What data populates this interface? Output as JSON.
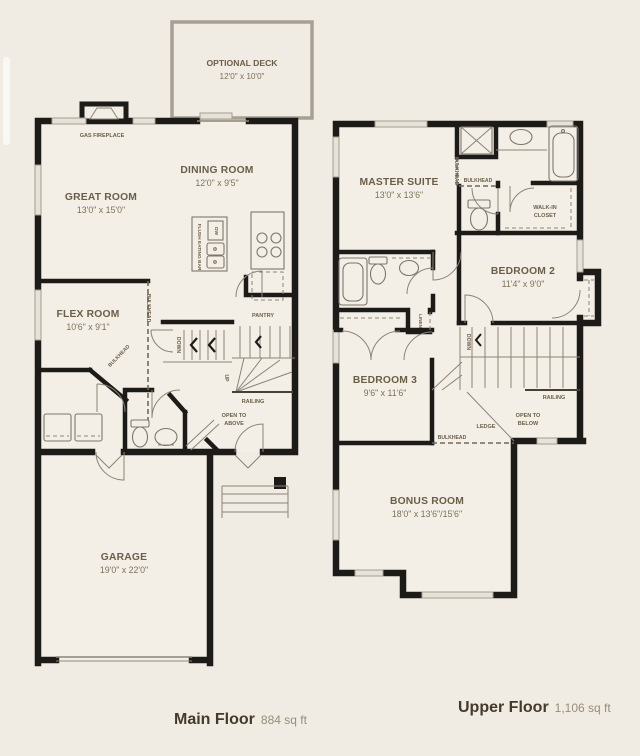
{
  "colors": {
    "background": "#f0ebe3",
    "wall": "#1c1b18",
    "label": "#6b5e46",
    "dim_label": "#7e7159",
    "deck_outline": "#a8a094",
    "caption_title": "#443a2c",
    "caption_area": "#9a8d79"
  },
  "main_floor": {
    "caption": "Main Floor",
    "area": "884 sq ft",
    "optional_deck": {
      "name": "OPTIONAL DECK",
      "dims": "12'0\" x 10'0\""
    },
    "gas_fireplace": "GAS FIREPLACE",
    "great_room": {
      "name": "GREAT ROOM",
      "dims": "13'0\" x 15'0\""
    },
    "dining_room": {
      "name": "DINING ROOM",
      "dims": "12'0\" x 9'5\""
    },
    "flex_room": {
      "name": "FLEX ROOM",
      "dims": "10'6\" x 9'1\""
    },
    "garage": {
      "name": "GARAGE",
      "dims": "19'0\" x 22'0\""
    },
    "flush_eating_bar": "FLUSH EATING BAR",
    "dw": "DW",
    "pantry": "PANTRY",
    "bulkhead": "BULKHEAD",
    "down": "DOWN",
    "up": "UP",
    "railing": "RAILING",
    "open_to_above_line1": "OPEN TO",
    "open_to_above_line2": "ABOVE"
  },
  "upper_floor": {
    "caption": "Upper Floor",
    "area": "1,106 sq ft",
    "master_suite": {
      "name": "MASTER SUITE",
      "dims": "13'0\" x 13'6\""
    },
    "bedroom_2": {
      "name": "BEDROOM 2",
      "dims": "11'4\" x 9'0\""
    },
    "bedroom_3": {
      "name": "BEDROOM 3",
      "dims": "9'6\" x 11'6\""
    },
    "bonus_room": {
      "name": "BONUS ROOM",
      "dims": "18'0\" x 13'6\"/15'6\""
    },
    "walk_in_closet_line1": "WALK-IN",
    "walk_in_closet_line2": "CLOSET",
    "linen": "LINEN",
    "bulkhead": "BULKHEAD",
    "down": "DOWN",
    "railing": "RAILING",
    "ledge": "LEDGE",
    "open_to_below_line1": "OPEN TO",
    "open_to_below_line2": "BELOW"
  }
}
